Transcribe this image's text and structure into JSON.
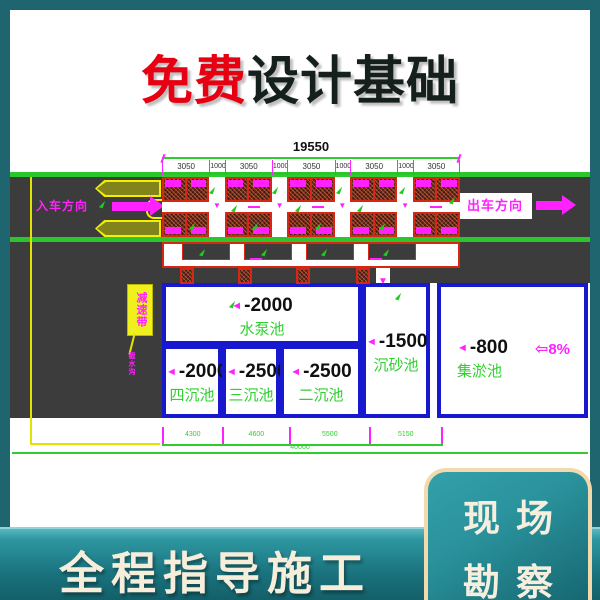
{
  "header": {
    "title_highlight": "免费",
    "title_rest": "设计基础"
  },
  "diagram": {
    "dim_total": "19550",
    "dim_segments": [
      "3050",
      "1000",
      "3050",
      "1000",
      "3050",
      "1000",
      "3050",
      "1000",
      "3050"
    ],
    "entry_label": "入车方向",
    "exit_label": "出车方向",
    "ramp_note": "减速带",
    "ramp_note_small": "截水沟",
    "slope_label": "8%",
    "pools": [
      {
        "depth": "-2000",
        "name": "水泵池"
      },
      {
        "depth": "-2000",
        "name": "四沉池"
      },
      {
        "depth": "-2500",
        "name": "三沉池"
      },
      {
        "depth": "-2500",
        "name": "二沉池"
      },
      {
        "depth": "-1500",
        "name": "沉砂池"
      },
      {
        "depth": "-800",
        "name": "集淤池"
      }
    ],
    "bottom_dims": [
      "4300",
      "4600",
      "5500",
      "5150"
    ],
    "bottom_total": "40000"
  },
  "footer": {
    "banner": "全程指导施工",
    "badge_top": "现场",
    "badge_bottom": "勘察"
  },
  "colors": {
    "accent_teal": "#1e6570",
    "cad_green": "#2ecc2e",
    "cad_magenta": "#ff22ff",
    "cad_blue": "#1818cf",
    "cad_red": "#d42814",
    "highlight_red": "#e60012",
    "cream": "#f6eedb"
  }
}
